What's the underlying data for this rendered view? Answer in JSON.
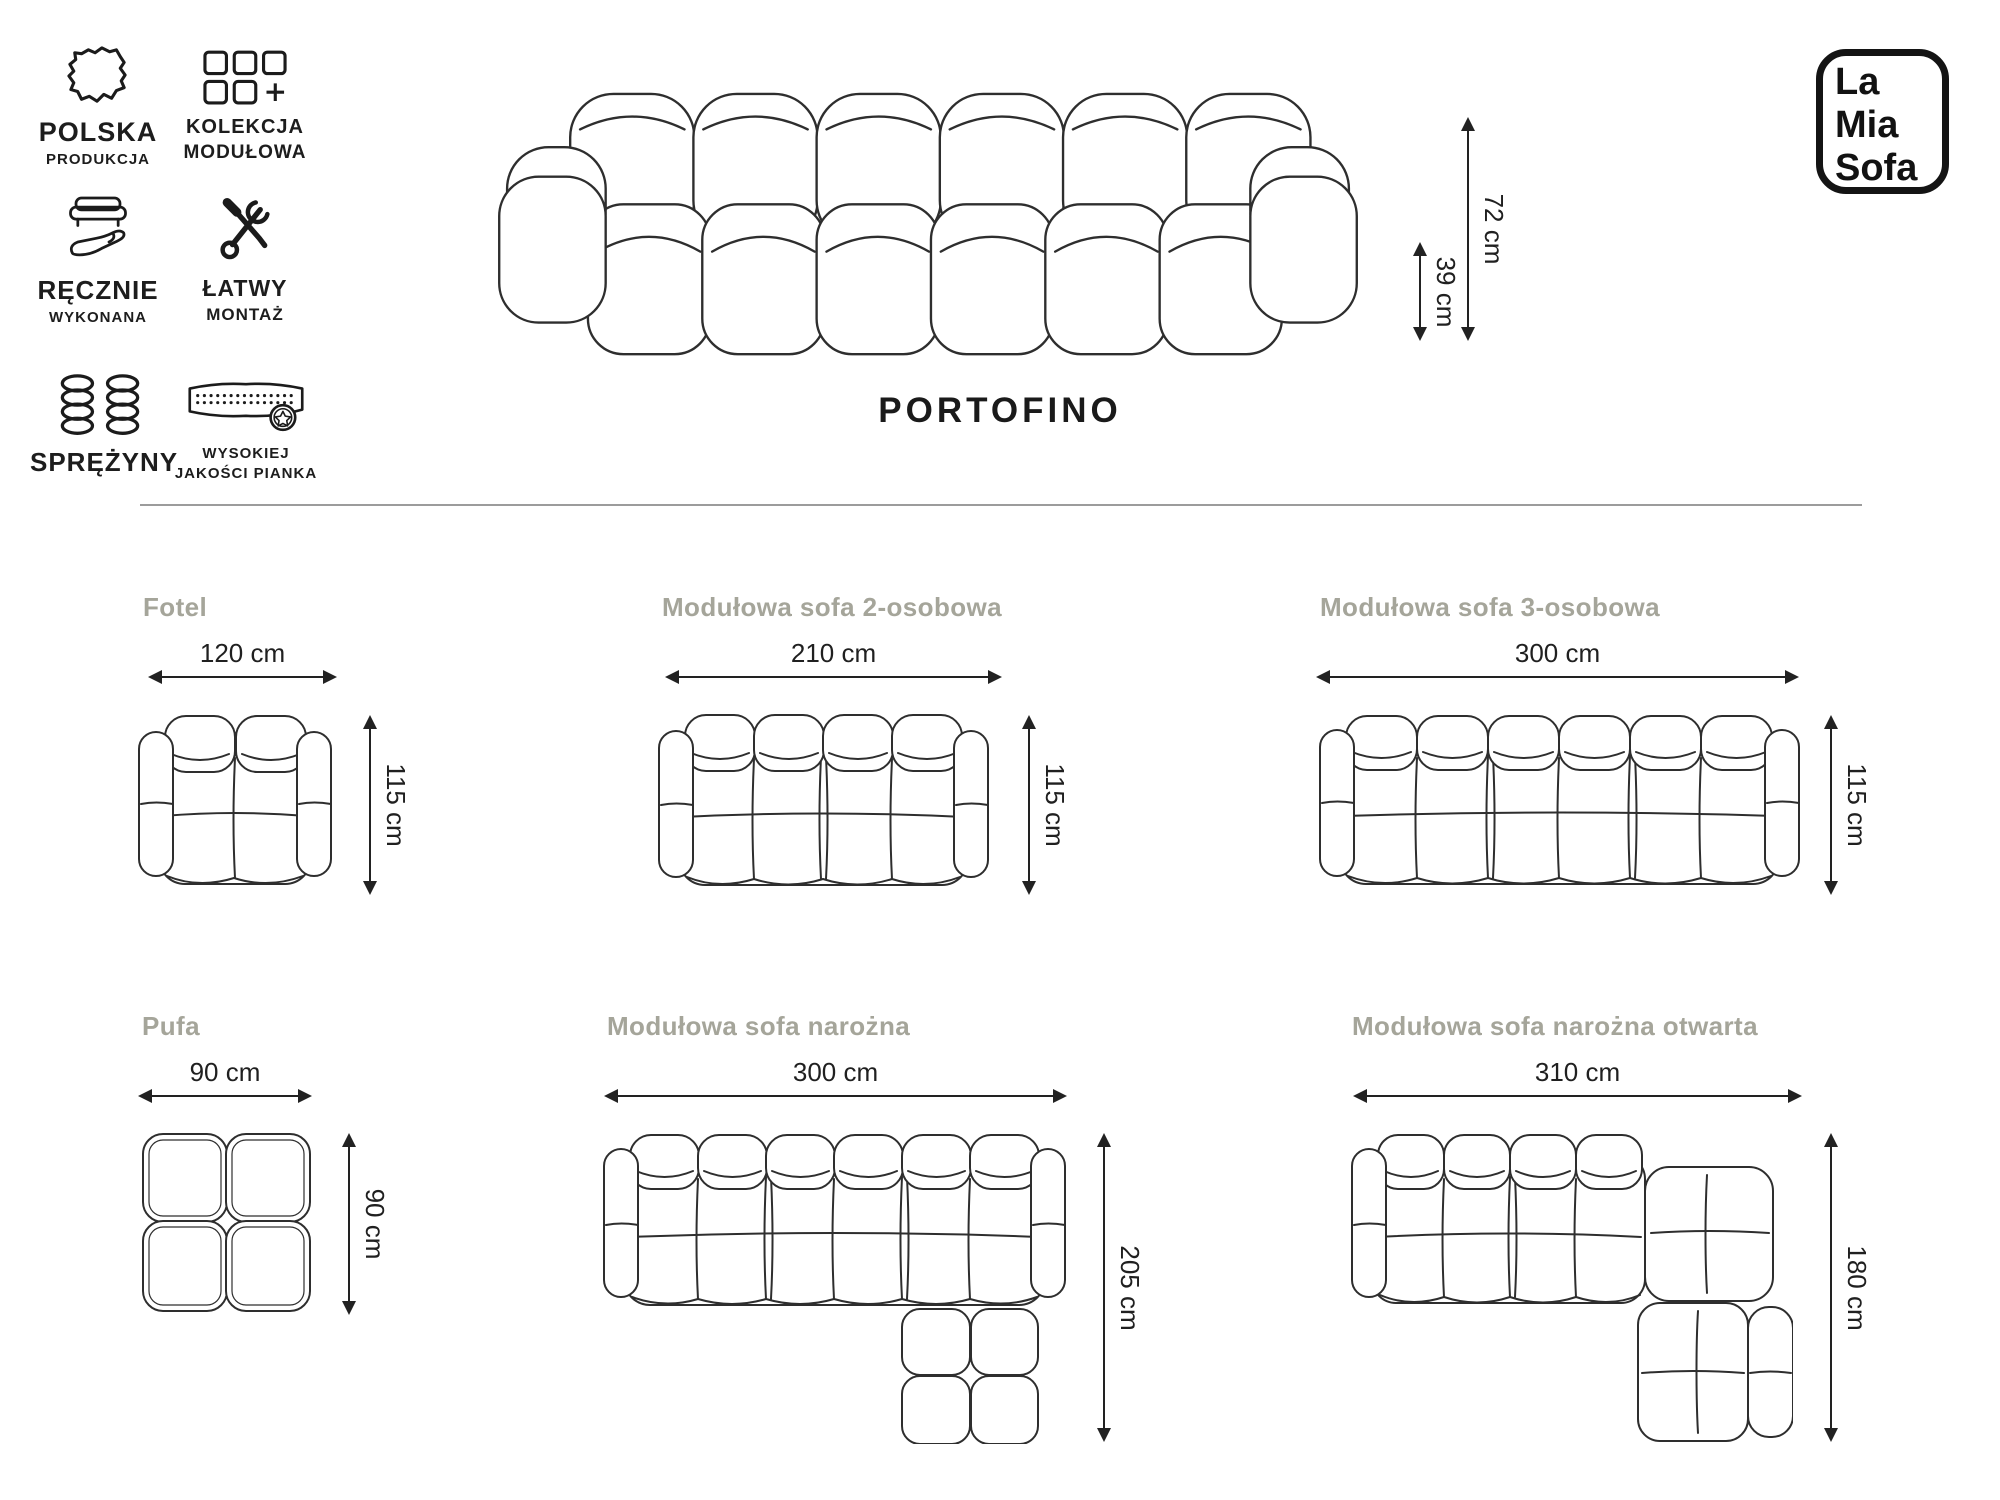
{
  "logo": {
    "line1": "La",
    "line2": "Mia",
    "line3": "Sofa"
  },
  "product": {
    "name": "PORTOFINO"
  },
  "hero_dimensions": {
    "total_height": "72 cm",
    "seat_height": "39 cm"
  },
  "features": [
    {
      "icon": "poland-map-icon",
      "line1": "POLSKA",
      "line2": "PRODUKCJA"
    },
    {
      "icon": "modules-plus-icon",
      "line1": "KOLEKCJA",
      "line2": "MODUŁOWA"
    },
    {
      "icon": "hand-sofa-icon",
      "line1": "RĘCZNIE",
      "line2": "WYKONANA"
    },
    {
      "icon": "crossed-tools-icon",
      "line1": "ŁATWY",
      "line2": "MONTAŻ"
    },
    {
      "icon": "springs-icon",
      "line1": "SPRĘŻYNY",
      "line2": ""
    },
    {
      "icon": "foam-badge-icon",
      "line1": "WYSOKIEJ",
      "line2": "JAKOŚCI PIANKA"
    }
  ],
  "variants": [
    {
      "name": "Fotel",
      "width": "120 cm",
      "depth": "115 cm"
    },
    {
      "name": "Modułowa sofa 2-osobowa",
      "width": "210 cm",
      "depth": "115 cm"
    },
    {
      "name": "Modułowa sofa 3-osobowa",
      "width": "300 cm",
      "depth": "115 cm"
    },
    {
      "name": "Pufa",
      "width": "90 cm",
      "depth": "90 cm"
    },
    {
      "name": "Modułowa sofa narożna",
      "width": "300 cm",
      "depth": "205 cm"
    },
    {
      "name": "Modułowa sofa narożna otwarta",
      "width": "310 cm",
      "depth": "180 cm"
    }
  ],
  "colors": {
    "text": "#1d1d1d",
    "muted_title": "#a5a59a",
    "line": "#2e2e2e",
    "divider": "#9c9c9c"
  }
}
